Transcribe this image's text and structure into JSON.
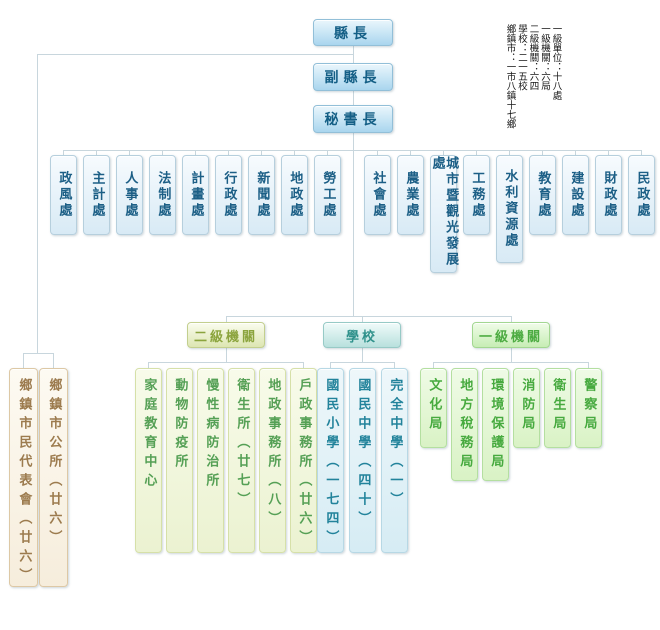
{
  "legend": {
    "lines": [
      "一級單位：十八處",
      "一級機關：六局",
      "二級機關：六四",
      "學校：二一五校",
      "鄉鎮市：一市八鎮十七鄉"
    ]
  },
  "leadership": {
    "magistrate": "縣長",
    "deputy_magistrate": "副縣長",
    "secretary_general": "秘書長"
  },
  "departments": [
    "政風處",
    "主計處",
    "人事處",
    "法制處",
    "計畫處",
    "行政處",
    "新聞處",
    "地政處",
    "勞工處",
    "社會處",
    "農業處",
    "城市暨觀光發展處",
    "工務處",
    "水利資源處",
    "教育處",
    "建設處",
    "財政處",
    "民政處"
  ],
  "township": {
    "items": [
      "鄉鎮市民代表會（廿六）",
      "鄉鎮市公所（廿六）"
    ]
  },
  "secondary_agencies": {
    "label": "二級機關",
    "children": [
      "家庭教育中心",
      "動物防疫所",
      "慢性病防治所",
      "衛生所（廿七）",
      "地政事務所（八）",
      "戶政事務所（廿六）"
    ]
  },
  "schools": {
    "label": "學校",
    "children": [
      "國民小學（一七四）",
      "國民中學（四十）",
      "完全中學（一）"
    ]
  },
  "primary_agencies": {
    "label": "一級機關",
    "children": [
      "文化局",
      "地方稅務局",
      "環境保護局",
      "消防局",
      "衛生局",
      "警察局"
    ]
  },
  "colors": {
    "connector": "#c8d6dd",
    "blue_text": "#145f86",
    "olive_text": "#8ba43d",
    "teal_text": "#2f918b",
    "green_text": "#47aa3f",
    "brown_text": "#9c7b4e"
  }
}
